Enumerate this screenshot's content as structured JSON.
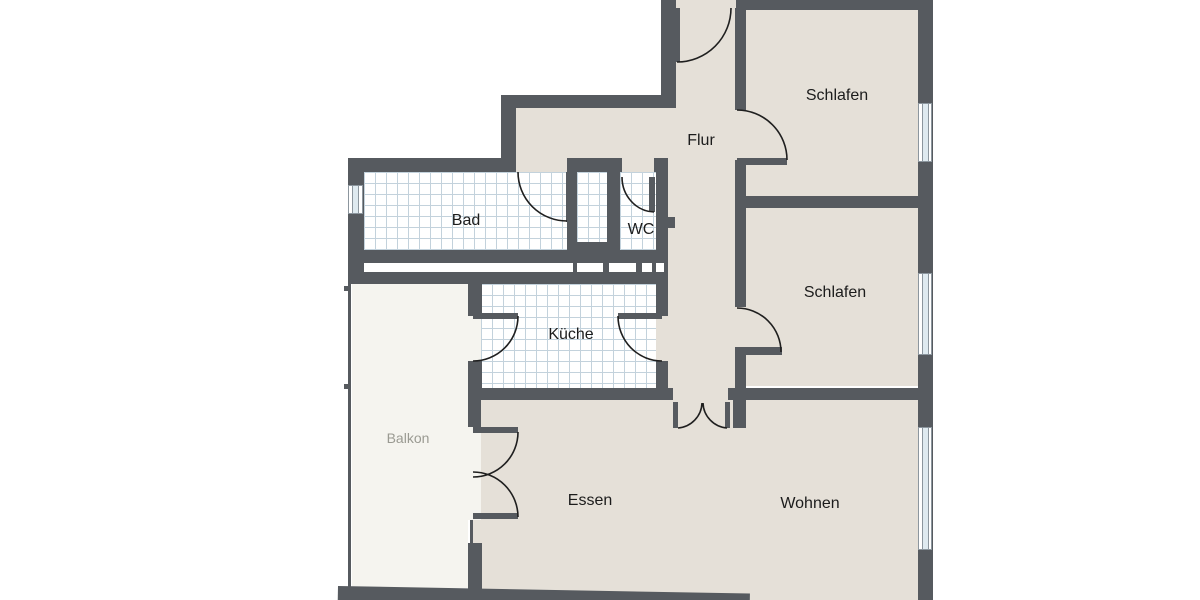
{
  "title": "Wohnungsgrundriss",
  "rooms": {
    "flur": {
      "label": "Flur"
    },
    "schlafen1": {
      "label": "Schlafen"
    },
    "schlafen2": {
      "label": "Schlafen"
    },
    "bad": {
      "label": "Bad"
    },
    "wc": {
      "label": "WC"
    },
    "kueche": {
      "label": "Küche"
    },
    "balkon": {
      "label": "Balkon"
    },
    "essen": {
      "label": "Essen"
    },
    "wohnen": {
      "label": "Wohnen"
    }
  },
  "features": {
    "windows": [
      "bad-window",
      "schlafen-top-window",
      "schlafen-bottom-window",
      "wohnen-window"
    ],
    "doors": [
      "entrance-door",
      "schlafen-top-door",
      "schlafen-bottom-door",
      "bad-door",
      "wc-door",
      "kueche-balkon-door",
      "kueche-flur-door",
      "essen-balkon-double-door",
      "flur-swing-door"
    ]
  },
  "colors": {
    "background": "#ffffff",
    "wall": "#565a5f",
    "floor": "#e5e0d8",
    "balcony_floor": "#f5f4ef",
    "tile_bg": "#ffffff",
    "tile_line": "#c3d2dc",
    "door_line": "#1f1f1f",
    "window_line": "#8c969e",
    "window_glass": "#dfeaf0",
    "label": "#1c1c1c",
    "balcony_label": "#9a9a92"
  }
}
